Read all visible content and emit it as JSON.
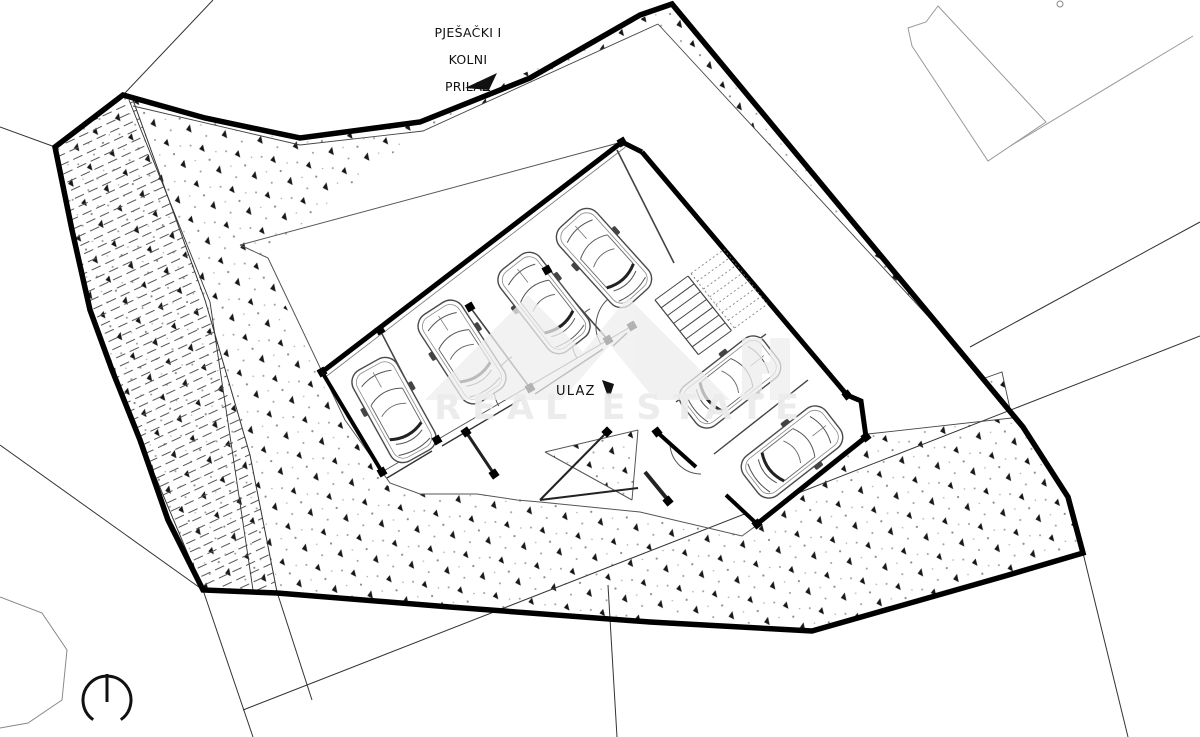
{
  "drawing": {
    "type": "architectural site plan, ground floor parking layout",
    "labels": {
      "access_line1": "PJEŠAČKI I",
      "access_line2": "KOLNI",
      "access_line3": "PRILAZ",
      "entrance": "ULAZ",
      "watermark": "REAL ESTATE"
    },
    "symbols": [
      "north-arrow",
      "access-direction-arrow",
      "entrance-direction-arrow"
    ],
    "counts": {
      "cars_drawn": 6,
      "garage_stalls_top_wing": 4,
      "parking_stalls_right_wing": 2,
      "staircases": 1
    },
    "colors": {
      "paper": "#ffffff",
      "boundary": "#000000",
      "linework": "#3a3a3a",
      "light_linework": "#999999",
      "ground_dot": "#8a8a8a",
      "watermark": "#eaeaea"
    }
  }
}
